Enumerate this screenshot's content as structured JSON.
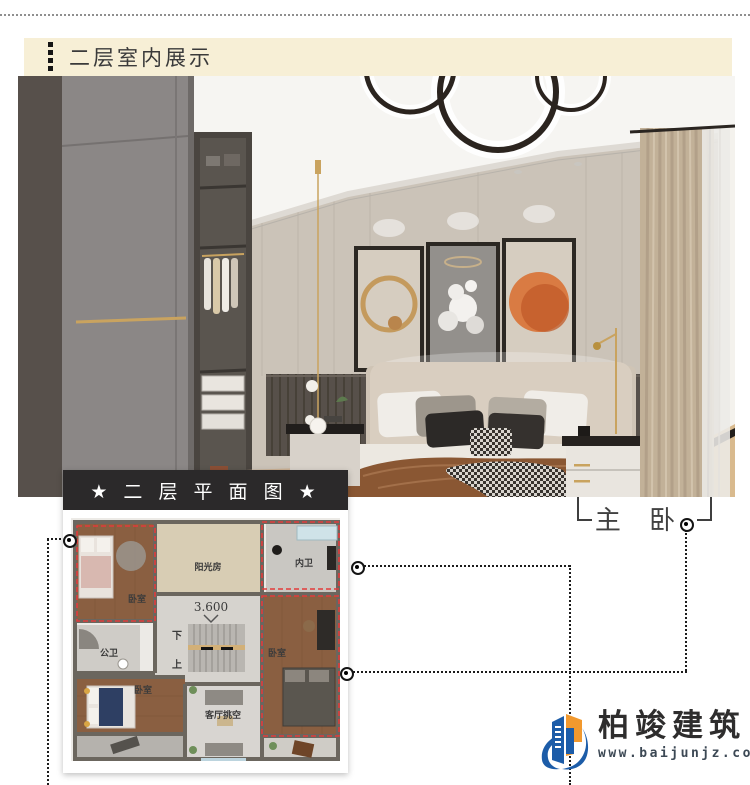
{
  "header": {
    "title": "二层室内展示"
  },
  "plan": {
    "title": "★ 二 层 平 面 图 ★",
    "elevation_label": "3.600",
    "stair_down": "下",
    "stair_up": "上",
    "rooms": {
      "bedroom_top_left": "卧室",
      "sunroom": "阳光房",
      "inner_bath": "内卫",
      "public_bath": "公卫",
      "bedroom_bottom_left": "卧室",
      "living_void": "客厅挑空",
      "master_bedroom": "卧室"
    }
  },
  "callout": {
    "label": "主 卧"
  },
  "logo": {
    "name": "柏竣建筑",
    "website": "www.baijunjz.com"
  },
  "colors": {
    "cream_bar": "#f7efd6",
    "plan_header_bg": "#2b292a",
    "highlight_red": "#e23b3b",
    "logo_blue": "#1c5ca8",
    "logo_orange": "#f2992e"
  }
}
